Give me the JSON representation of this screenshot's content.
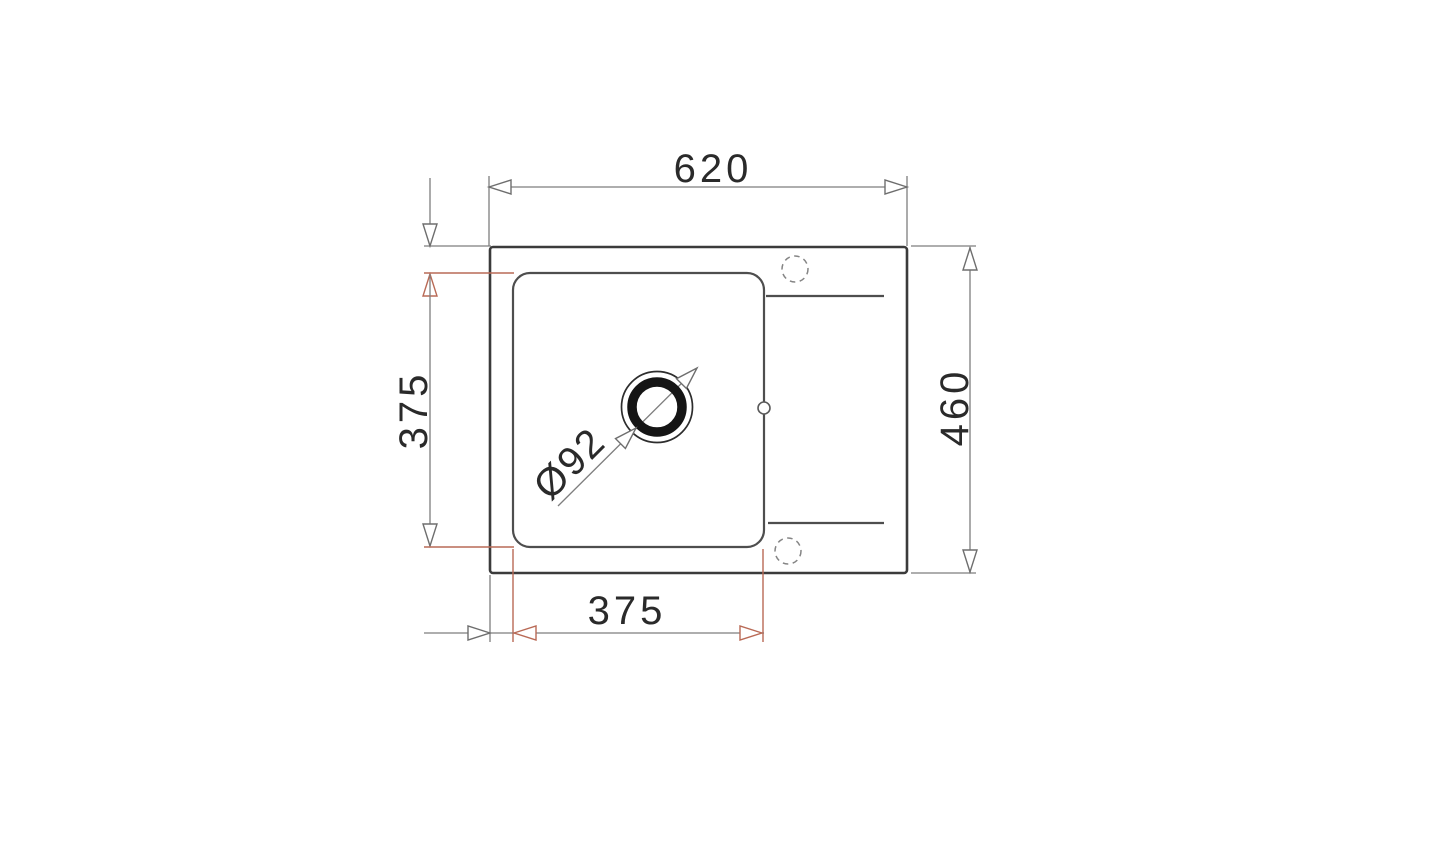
{
  "drawing": {
    "labels": {
      "overall_width": "620",
      "overall_depth": "460",
      "bowl_depth": "375",
      "bowl_width": "375",
      "drain_diameter": "Ø92"
    },
    "colors": {
      "background": "#ffffff",
      "sink_outline": "#3b3b3b",
      "bowl_outline": "#4e4e4e",
      "dimension_gray": "#7e7e7e",
      "dimension_red": "#b96a56",
      "drain_ring": "#151515",
      "text": "#2a2a2a"
    }
  }
}
